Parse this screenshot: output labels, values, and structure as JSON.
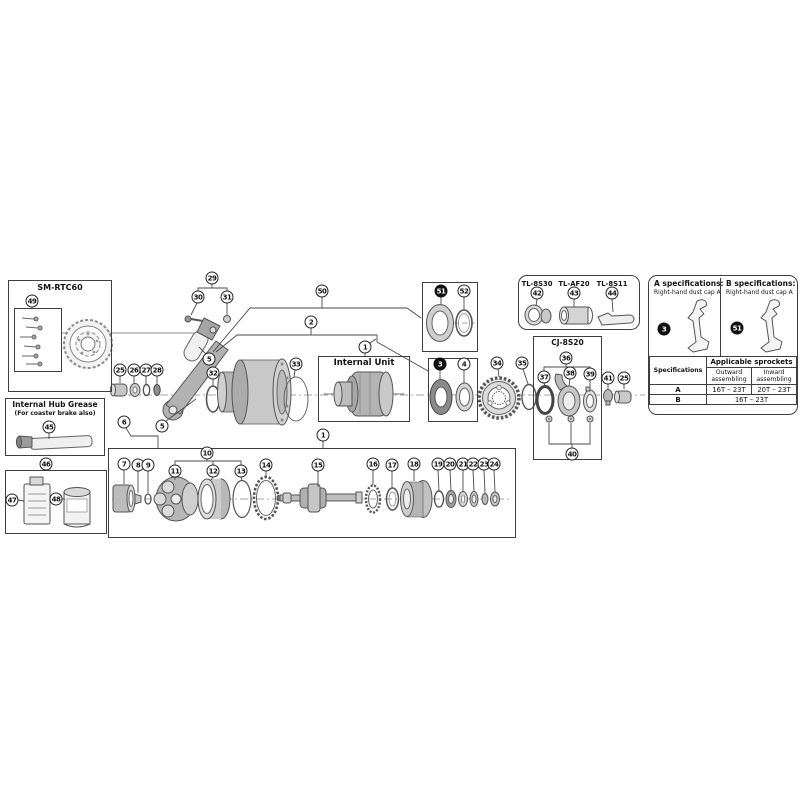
{
  "colors": {
    "line": "#3f3f3f",
    "part_light": "#e8e8e8",
    "part_mid": "#bcbcbc",
    "part_dark": "#777777",
    "callout_fill": "#ffffff",
    "callout_filled": "#111111"
  },
  "boxes": {
    "sm_rtc60": {
      "title": "SM-RTC60"
    },
    "grease": {
      "title": "Internal Hub Grease",
      "subtitle": "(For coaster brake also)"
    },
    "internal_unit": {
      "title": "Internal Unit"
    },
    "cj": {
      "title": "CJ-8S20"
    },
    "tools": {
      "items": [
        {
          "label": "TL-8S30"
        },
        {
          "label": "TL-AF20"
        },
        {
          "label": "TL-8S11"
        }
      ]
    }
  },
  "specs": {
    "a": {
      "title": "A specifications:",
      "subtitle": "Right-hand dust cap A",
      "callout": "3"
    },
    "b": {
      "title": "B specifications:",
      "subtitle": "Right-hand dust cap A",
      "callout": "51"
    },
    "table": {
      "row_header": "Specifications",
      "group_header": "Applicable sprockets",
      "cols": [
        "Outward assembling",
        "Inward assembling"
      ],
      "rows": [
        {
          "label": "A",
          "outward": "16T – 23T",
          "inward": "20T – 23T"
        },
        {
          "label": "B",
          "both": "16T – 23T"
        }
      ]
    }
  },
  "callouts": [
    {
      "n": "49",
      "x": 32,
      "y": 301
    },
    {
      "n": "45",
      "x": 49,
      "y": 427
    },
    {
      "n": "46",
      "x": 46,
      "y": 464
    },
    {
      "n": "47",
      "x": 12,
      "y": 500
    },
    {
      "n": "48",
      "x": 56,
      "y": 499
    },
    {
      "n": "29",
      "x": 212,
      "y": 278
    },
    {
      "n": "30",
      "x": 198,
      "y": 297
    },
    {
      "n": "31",
      "x": 227,
      "y": 297
    },
    {
      "n": "50",
      "x": 322,
      "y": 291
    },
    {
      "n": "2",
      "x": 311,
      "y": 322
    },
    {
      "n": "51",
      "x": 441,
      "y": 291,
      "filled": true
    },
    {
      "n": "52",
      "x": 464,
      "y": 291
    },
    {
      "n": "42",
      "x": 537,
      "y": 293
    },
    {
      "n": "43",
      "x": 574,
      "y": 293
    },
    {
      "n": "44",
      "x": 612,
      "y": 293
    },
    {
      "n": "3",
      "x": 664,
      "y": 329,
      "filled": true
    },
    {
      "n": "51",
      "x": 737,
      "y": 328,
      "filled": true
    },
    {
      "n": "5",
      "x": 209,
      "y": 359
    },
    {
      "n": "25",
      "x": 120,
      "y": 370
    },
    {
      "n": "26",
      "x": 134,
      "y": 370
    },
    {
      "n": "27",
      "x": 146,
      "y": 370
    },
    {
      "n": "28",
      "x": 157,
      "y": 370
    },
    {
      "n": "32",
      "x": 213,
      "y": 373
    },
    {
      "n": "33",
      "x": 296,
      "y": 364
    },
    {
      "n": "1",
      "x": 365,
      "y": 347
    },
    {
      "n": "3",
      "x": 440,
      "y": 364,
      "filled": true
    },
    {
      "n": "4",
      "x": 464,
      "y": 364
    },
    {
      "n": "34",
      "x": 497,
      "y": 363
    },
    {
      "n": "35",
      "x": 522,
      "y": 363
    },
    {
      "n": "36",
      "x": 566,
      "y": 358
    },
    {
      "n": "37",
      "x": 544,
      "y": 377
    },
    {
      "n": "38",
      "x": 570,
      "y": 373
    },
    {
      "n": "39",
      "x": 590,
      "y": 374
    },
    {
      "n": "40",
      "x": 572,
      "y": 454
    },
    {
      "n": "41",
      "x": 608,
      "y": 378
    },
    {
      "n": "25",
      "x": 624,
      "y": 378
    },
    {
      "n": "6",
      "x": 124,
      "y": 422
    },
    {
      "n": "5",
      "x": 162,
      "y": 426
    },
    {
      "n": "1",
      "x": 323,
      "y": 435
    },
    {
      "n": "7",
      "x": 124,
      "y": 464
    },
    {
      "n": "8",
      "x": 138,
      "y": 465
    },
    {
      "n": "9",
      "x": 148,
      "y": 465
    },
    {
      "n": "10",
      "x": 207,
      "y": 453
    },
    {
      "n": "11",
      "x": 175,
      "y": 471
    },
    {
      "n": "12",
      "x": 213,
      "y": 471
    },
    {
      "n": "13",
      "x": 241,
      "y": 471
    },
    {
      "n": "14",
      "x": 266,
      "y": 465
    },
    {
      "n": "15",
      "x": 318,
      "y": 465
    },
    {
      "n": "16",
      "x": 373,
      "y": 464
    },
    {
      "n": "17",
      "x": 392,
      "y": 465
    },
    {
      "n": "18",
      "x": 414,
      "y": 464
    },
    {
      "n": "19",
      "x": 438,
      "y": 464
    },
    {
      "n": "20",
      "x": 450,
      "y": 464
    },
    {
      "n": "21",
      "x": 463,
      "y": 464
    },
    {
      "n": "22",
      "x": 473,
      "y": 464
    },
    {
      "n": "23",
      "x": 484,
      "y": 464
    },
    {
      "n": "24",
      "x": 494,
      "y": 464
    }
  ]
}
